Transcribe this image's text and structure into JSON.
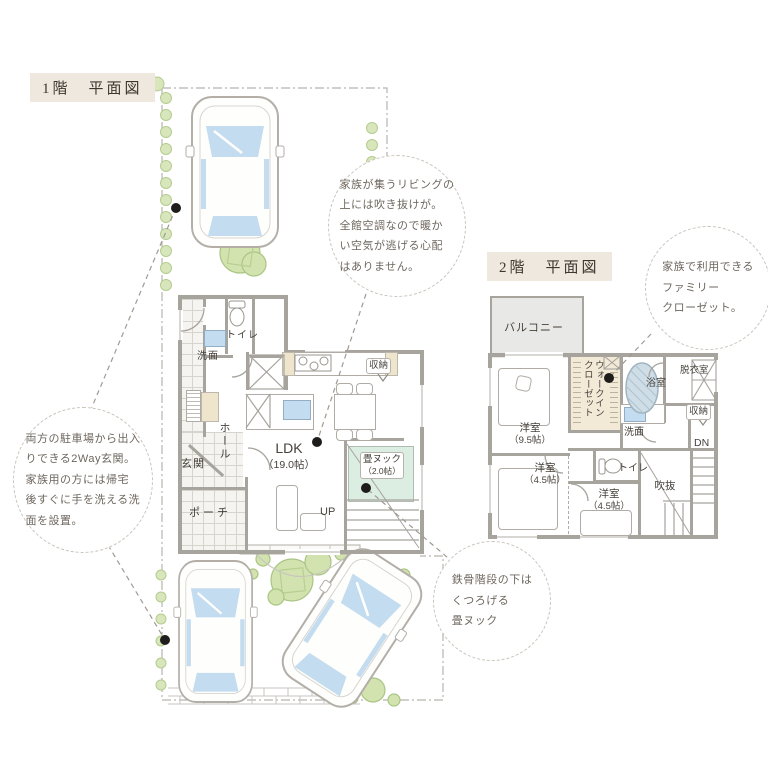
{
  "titles": {
    "floor1": "1階　平面図",
    "floor2": "2階　平面図"
  },
  "floor1": {
    "toilet": "トイレ",
    "wash": "洗面",
    "hall": "ホール",
    "entrance": "玄関",
    "porch": "ポーチ",
    "ldk": "LDK",
    "ldk_size": "（19.0帖）",
    "storage": "収納",
    "nook": "畳ヌック",
    "nook_size": "（2.0帖）",
    "up": "UP"
  },
  "floor2": {
    "balcony": "バルコニー",
    "bedroom1": "洋室",
    "bedroom1_size": "（9.5帖）",
    "wic_line1": "ウォークイン",
    "wic_line2": "クローゼット",
    "bath": "浴室",
    "dressing": "脱衣室",
    "storage": "収納",
    "wash": "洗面",
    "toilet": "トイレ",
    "void": "吹抜",
    "down": "DN",
    "bedroom2": "洋室",
    "bedroom2_size": "（4.5帖）",
    "bedroom3": "洋室",
    "bedroom3_size": "（4.5帖）"
  },
  "callouts": {
    "living": {
      "lines": [
        "家族が集うリビングの",
        "上には吹き抜けが。",
        "全館空調なので暖か",
        "い空気が逃げる心配",
        "はありません。"
      ]
    },
    "twoway": {
      "lines": [
        "両方の駐車場から出入",
        "りできる2Way玄関。",
        "家族用の方には帰宅",
        "後すぐに手を洗える洗",
        "面を設置。"
      ]
    },
    "nook": {
      "lines": [
        "鉄骨階段の下は",
        "くつろげる",
        "畳ヌック"
      ]
    },
    "familycloset": {
      "lines": [
        "家族で利用できる",
        "ファミリー",
        "クローゼット。"
      ]
    }
  },
  "colors": {
    "wall": "#a7a39d",
    "tatami_nook": "#dcede2",
    "wic_fill": "#f2ead7",
    "balcony_fill": "#e8e8e6",
    "window_glass": "#c3dcef",
    "greenery": "#d9e6bc",
    "title_bg": "#efe8df",
    "callout_text": "#6e675e",
    "leader_dot": "#1f1d1b"
  }
}
